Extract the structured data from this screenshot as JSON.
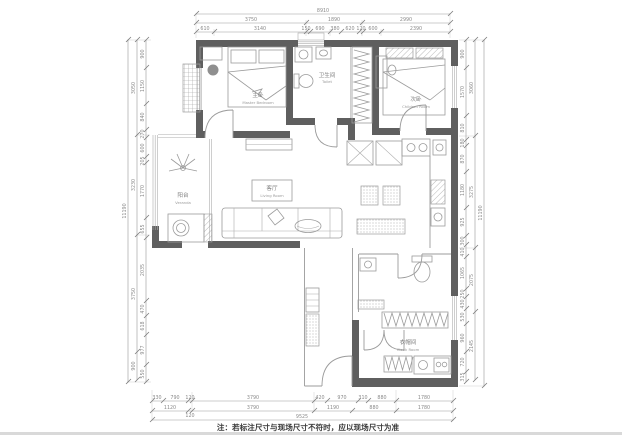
{
  "note": "注：若标注尺寸与现场尺寸不符时，应以现场尺寸为准",
  "colors": {
    "wall": "#5f5f5f",
    "furniture_line": "#9b9b9b",
    "dimension_text": "#8a8a8a",
    "note_text": "#3a3a3a",
    "background": "#ffffff"
  },
  "rooms": {
    "master": {
      "cn": "主卧",
      "en": "Master Bedroom"
    },
    "bath": {
      "cn": "卫生间",
      "en": "Toilet"
    },
    "second": {
      "cn": "次卧",
      "en": "Children Room"
    },
    "balcony": {
      "cn": "阳台",
      "en": "Veranda"
    },
    "living": {
      "cn": "客厅",
      "en": "Living Room"
    },
    "cloak": {
      "cn": "衣帽间",
      "en": "Cloak Room"
    }
  },
  "dims": {
    "top": {
      "total": "8910",
      "row2": [
        "3750",
        "1890",
        "2990"
      ],
      "row3": [
        "610",
        "3140",
        "150",
        "690",
        "380",
        "620",
        "120",
        "600",
        "2390"
      ]
    },
    "bottom": {
      "row1": [
        "330",
        "790",
        "120",
        "3790",
        "420",
        "970",
        "310",
        "880",
        "1780"
      ],
      "row2": [
        "1120",
        "120",
        "3790",
        "1190",
        "880",
        "1780"
      ],
      "total": "9525"
    },
    "left": {
      "inner": [
        "900",
        "1150",
        "840",
        "270",
        "600",
        "205",
        "1770",
        "655",
        "2035",
        "470",
        "618",
        "977",
        "550"
      ],
      "mid": [
        "3050",
        "3230",
        "3750",
        "900"
      ],
      "total": "11190"
    },
    "right": {
      "inner": [
        "900",
        "1570",
        "810",
        "180",
        "870",
        "1180",
        "925",
        "300",
        "410",
        "1065",
        "250",
        "430",
        "530",
        "960",
        "720",
        "315"
      ],
      "mid": [
        "3060",
        "3275",
        "2075",
        "2145"
      ],
      "total": "11190"
    }
  }
}
